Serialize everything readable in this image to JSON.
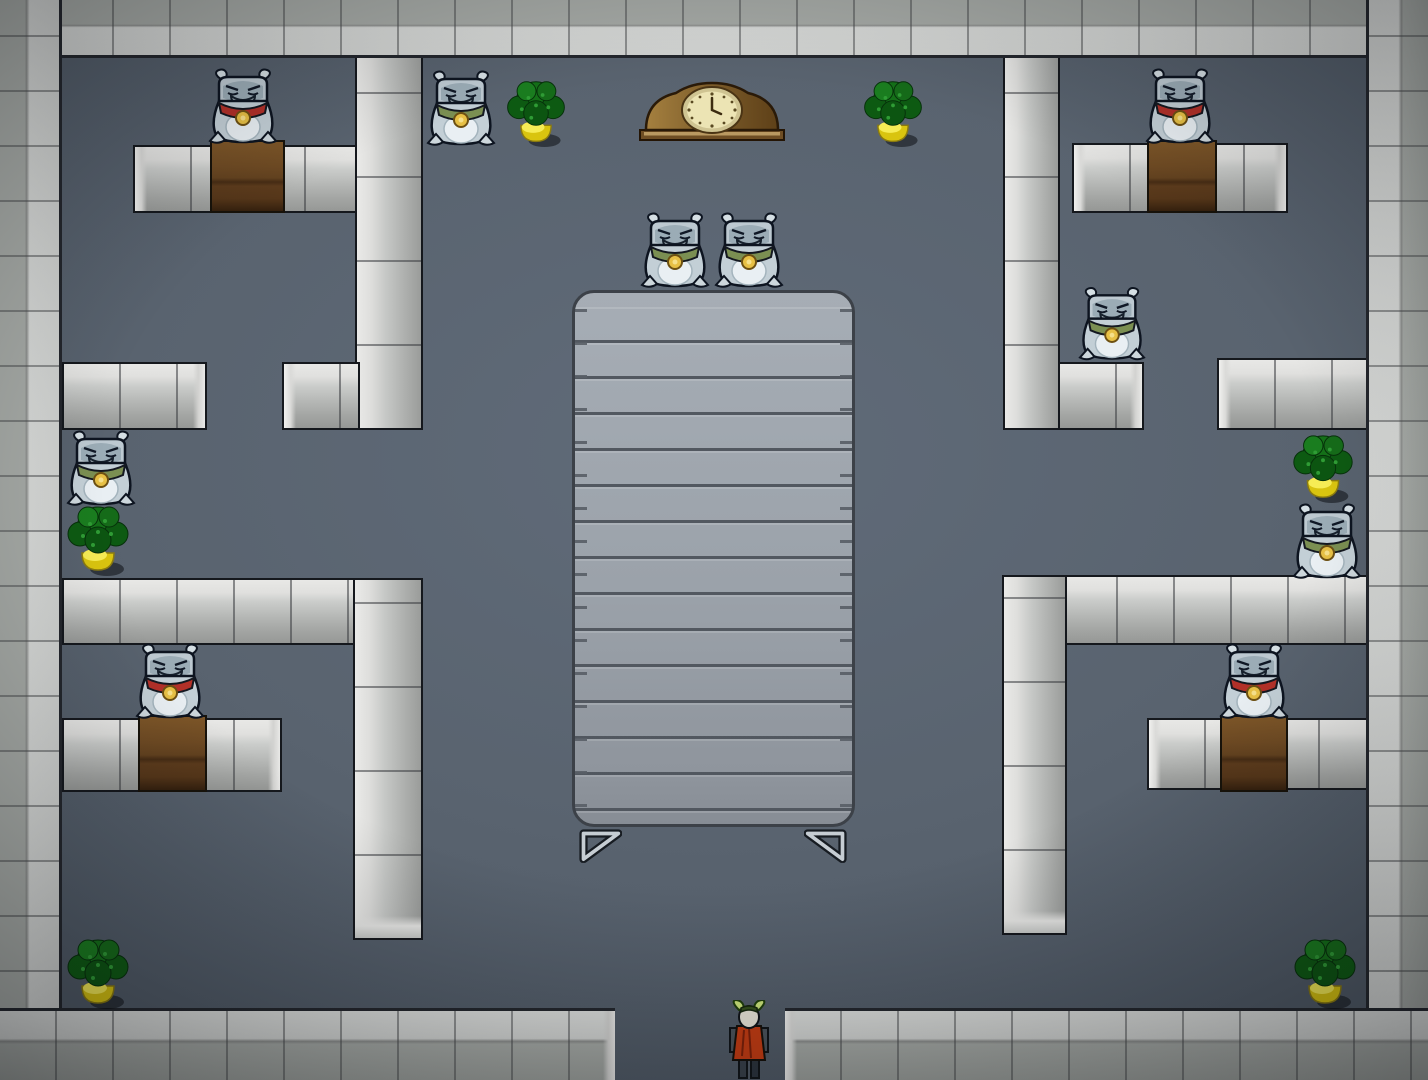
{
  "scene": {
    "description": "stone-room-with-creatures",
    "canvas": {
      "width": 1428,
      "height": 1080
    },
    "colors": {
      "floor": "#59636f",
      "wall_light": "#e8e8e6",
      "wall_mid": "#b4b6b4",
      "wall_dark": "#9a9c9a",
      "outline": "#15181d",
      "border_outer": "#a7aba7",
      "border_inner": "#d8dad8",
      "desk_brown": "#6e4a23",
      "table_gray": "#9ba2aa",
      "table_line": "#585e66",
      "scarf_red": "#b23028",
      "scarf_green": "#7b8f52",
      "medallion_gold": "#e7c045",
      "bush_green": "#147018",
      "pot_yellow": "#d9c40f",
      "clock_brown": "#7c5c2a",
      "clock_face": "#ece4b4",
      "player_tunic": "#c63c12"
    },
    "border": {
      "top": {
        "x": 0,
        "y": 0,
        "w": 1428,
        "h": 58
      },
      "left": {
        "x": 0,
        "y": 0,
        "w": 62,
        "h": 1080
      },
      "right": {
        "x": 1366,
        "y": 0,
        "w": 62,
        "h": 1080
      },
      "bottom_left": {
        "x": 0,
        "y": 1008,
        "w": 615,
        "h": 72
      },
      "bottom_right": {
        "x": 785,
        "y": 1008,
        "w": 643,
        "h": 72
      },
      "doorway": {
        "x": 615,
        "y": 1008,
        "w": 170,
        "h": 72
      }
    },
    "walls": [
      {
        "id": "wall-nw-vertical",
        "x": 355,
        "y": 30,
        "w": 68,
        "h": 400,
        "dir": "v",
        "caps": ""
      },
      {
        "id": "wall-nw-foot",
        "x": 282,
        "y": 362,
        "w": 78,
        "h": 68,
        "dir": "h",
        "caps": "l"
      },
      {
        "id": "bench-nw",
        "x": 133,
        "y": 145,
        "w": 224,
        "h": 68,
        "dir": "h",
        "caps": "l"
      },
      {
        "id": "bench-w",
        "x": 62,
        "y": 362,
        "w": 145,
        "h": 68,
        "dir": "h",
        "caps": "r"
      },
      {
        "id": "wall-sw-horizontal",
        "x": 62,
        "y": 578,
        "w": 295,
        "h": 67,
        "dir": "h",
        "caps": ""
      },
      {
        "id": "wall-sw-vertical",
        "x": 353,
        "y": 578,
        "w": 70,
        "h": 362,
        "dir": "v",
        "caps": "b"
      },
      {
        "id": "bench-sw",
        "x": 62,
        "y": 718,
        "w": 220,
        "h": 74,
        "dir": "h",
        "caps": "r"
      },
      {
        "id": "wall-ne-vertical",
        "x": 1003,
        "y": 30,
        "w": 57,
        "h": 400,
        "dir": "v",
        "caps": ""
      },
      {
        "id": "wall-ne-foot",
        "x": 1058,
        "y": 362,
        "w": 86,
        "h": 68,
        "dir": "h",
        "caps": "r"
      },
      {
        "id": "bench-ne",
        "x": 1072,
        "y": 143,
        "w": 216,
        "h": 70,
        "dir": "h",
        "caps": "lr"
      },
      {
        "id": "bench-e",
        "x": 1217,
        "y": 358,
        "w": 151,
        "h": 72,
        "dir": "h",
        "caps": "l"
      },
      {
        "id": "wall-se-horizontal",
        "x": 1002,
        "y": 575,
        "w": 366,
        "h": 70,
        "dir": "h",
        "caps": ""
      },
      {
        "id": "wall-se-vertical",
        "x": 1002,
        "y": 575,
        "w": 65,
        "h": 360,
        "dir": "v",
        "caps": "b"
      },
      {
        "id": "bench-se",
        "x": 1147,
        "y": 718,
        "w": 221,
        "h": 72,
        "dir": "h",
        "caps": "l"
      }
    ],
    "desks": [
      {
        "id": "desk-nw",
        "x": 210,
        "y": 140,
        "w": 75,
        "h": 73
      },
      {
        "id": "desk-ne",
        "x": 1147,
        "y": 140,
        "w": 70,
        "h": 73
      },
      {
        "id": "desk-sw",
        "x": 138,
        "y": 715,
        "w": 69,
        "h": 77
      },
      {
        "id": "desk-se",
        "x": 1220,
        "y": 715,
        "w": 68,
        "h": 77
      }
    ],
    "table": {
      "x": 572,
      "y": 290,
      "w": 283,
      "h": 537,
      "feet": [
        {
          "x": 578,
          "y": 828,
          "w": 44,
          "h": 36,
          "side": "left"
        },
        {
          "x": 804,
          "y": 828,
          "w": 44,
          "h": 36,
          "side": "right"
        }
      ]
    },
    "clock": {
      "x": 636,
      "y": 78,
      "w": 152,
      "h": 66
    },
    "plants": [
      {
        "id": "plant-top-west",
        "x": 498,
        "y": 78,
        "w": 76,
        "h": 70
      },
      {
        "id": "plant-top-east",
        "x": 855,
        "y": 78,
        "w": 76,
        "h": 70
      },
      {
        "id": "plant-mid-west",
        "x": 60,
        "y": 503,
        "w": 76,
        "h": 74
      },
      {
        "id": "plant-mid-east",
        "x": 1286,
        "y": 432,
        "w": 74,
        "h": 72
      },
      {
        "id": "plant-bottom-west",
        "x": 58,
        "y": 936,
        "w": 80,
        "h": 74
      },
      {
        "id": "plant-bottom-east",
        "x": 1286,
        "y": 936,
        "w": 78,
        "h": 74
      }
    ],
    "creatures": [
      {
        "id": "creature-desk-nw",
        "x": 206,
        "y": 68,
        "w": 74,
        "h": 76,
        "scarf": "red"
      },
      {
        "id": "creature-top-west",
        "x": 424,
        "y": 70,
        "w": 74,
        "h": 76,
        "scarf": "green"
      },
      {
        "id": "creature-center-1",
        "x": 638,
        "y": 212,
        "w": 74,
        "h": 76,
        "scarf": "green"
      },
      {
        "id": "creature-center-2",
        "x": 712,
        "y": 212,
        "w": 74,
        "h": 76,
        "scarf": "green"
      },
      {
        "id": "creature-desk-ne",
        "x": 1143,
        "y": 68,
        "w": 74,
        "h": 76,
        "scarf": "red"
      },
      {
        "id": "creature-east-top",
        "x": 1076,
        "y": 286,
        "w": 72,
        "h": 75,
        "scarf": "green"
      },
      {
        "id": "creature-west-mid",
        "x": 64,
        "y": 430,
        "w": 74,
        "h": 76,
        "scarf": "green"
      },
      {
        "id": "creature-east-mid",
        "x": 1290,
        "y": 503,
        "w": 74,
        "h": 76,
        "scarf": "green"
      },
      {
        "id": "creature-desk-sw",
        "x": 132,
        "y": 643,
        "w": 76,
        "h": 76,
        "scarf": "red"
      },
      {
        "id": "creature-desk-se",
        "x": 1216,
        "y": 643,
        "w": 76,
        "h": 76,
        "scarf": "red"
      }
    ],
    "player": {
      "x": 725,
      "y": 1000,
      "w": 48,
      "h": 80
    }
  }
}
